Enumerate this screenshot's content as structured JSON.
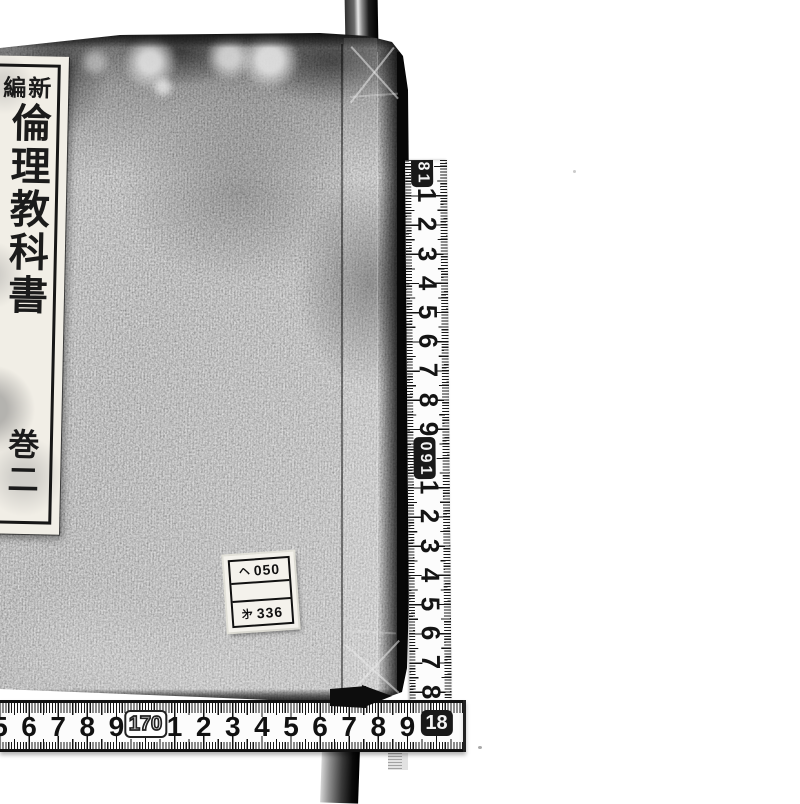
{
  "photo": {
    "subject": "traditional bound book with measuring tapes",
    "background_color": "#ffffff",
    "cover_color": "#949494",
    "ink_color": "#111111",
    "tape_color": "#fcfcfc"
  },
  "book": {
    "title_label": {
      "series": "新編",
      "title": "倫理教科書",
      "volume": "巻二"
    },
    "call_number_label": {
      "rows": [
        {
          "prefix": "ヘ",
          "number": "050"
        },
        {
          "prefix": "",
          "number": ""
        },
        {
          "prefix": "㐧",
          "number": "336"
        }
      ]
    }
  },
  "vertical_ruler": {
    "labels": [
      {
        "text": "180",
        "boxed": true
      },
      {
        "text": "1"
      },
      {
        "text": "2"
      },
      {
        "text": "3"
      },
      {
        "text": "4"
      },
      {
        "text": "5"
      },
      {
        "text": "6"
      },
      {
        "text": "7"
      },
      {
        "text": "8"
      },
      {
        "text": "9"
      },
      {
        "text": "190",
        "boxed": true
      },
      {
        "text": "1"
      },
      {
        "text": "2"
      },
      {
        "text": "3"
      },
      {
        "text": "4"
      },
      {
        "text": "5"
      },
      {
        "text": "6"
      },
      {
        "text": "7"
      },
      {
        "text": "8"
      }
    ]
  },
  "horizontal_ruler": {
    "labels": [
      {
        "text": "5"
      },
      {
        "text": "6"
      },
      {
        "text": "7"
      },
      {
        "text": "8"
      },
      {
        "text": "9"
      },
      {
        "text": "170",
        "boxed": true,
        "style": "outline"
      },
      {
        "text": "1"
      },
      {
        "text": "2"
      },
      {
        "text": "3"
      },
      {
        "text": "4"
      },
      {
        "text": "5"
      },
      {
        "text": "6"
      },
      {
        "text": "7"
      },
      {
        "text": "8"
      },
      {
        "text": "9"
      },
      {
        "text": "18",
        "boxed": true,
        "style": "inverted"
      }
    ]
  }
}
